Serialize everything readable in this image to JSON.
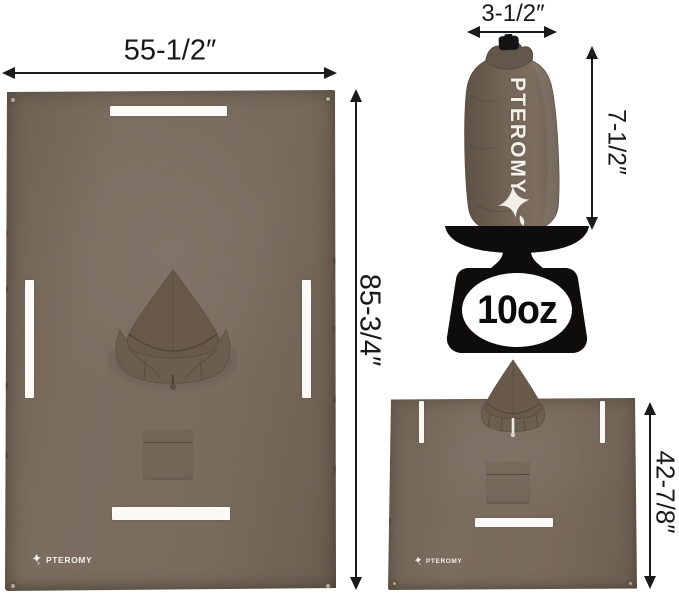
{
  "brand": "PTEROMY",
  "colors": {
    "fabric": "#786a5d",
    "fabric_dark": "#675a4d",
    "reflective_strip": "#fbfaf6",
    "scale_black": "#0e0d0b",
    "dimension_ink": "#1b1b1b",
    "background": "#ffffff"
  },
  "flat_tarp": {
    "width_label": "55-1/2″",
    "height_label": "85-3/4″"
  },
  "stuff_sack": {
    "width_label": "3-1/2″",
    "height_label": "7-1/2″"
  },
  "scale": {
    "weight_label": "10oz"
  },
  "worn_poncho": {
    "height_label": "42-7/8″"
  }
}
